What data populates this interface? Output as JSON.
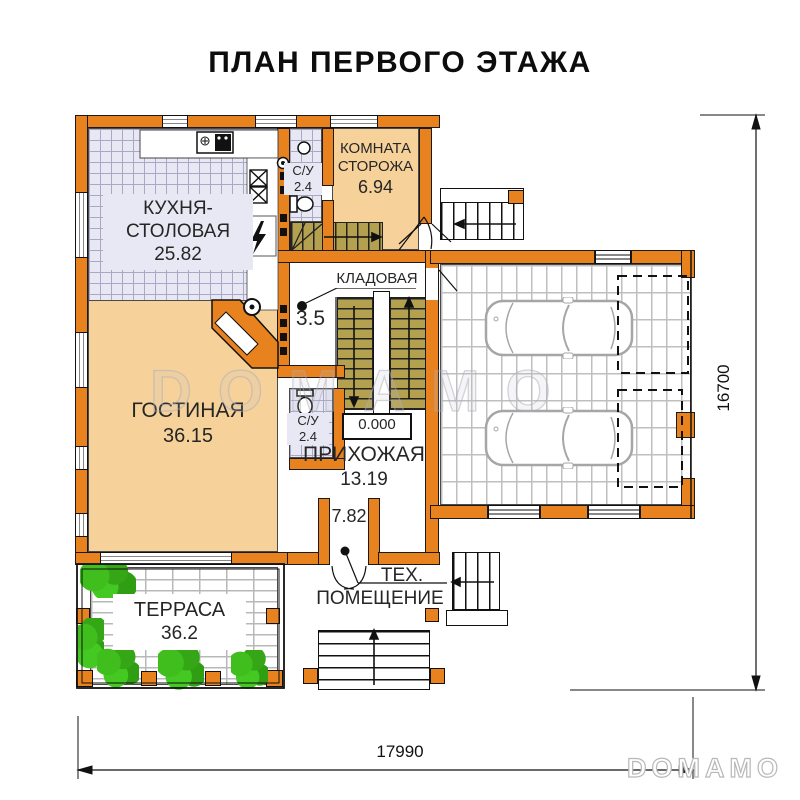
{
  "title": "ПЛАН ПЕРВОГО ЭТАЖА",
  "rooms": {
    "kitchen": {
      "name_line1": "КУХНЯ-",
      "name_line2": "СТОЛОВАЯ",
      "area": "25.82"
    },
    "guard": {
      "name_line1": "КОМНАТА",
      "name_line2": "СТОРОЖА",
      "area": "6.94"
    },
    "bath_top": {
      "name": "С/У",
      "area": "2.4"
    },
    "pantry": {
      "label": "КЛАДОВАЯ",
      "area": "3.5"
    },
    "living": {
      "name": "ГОСТИНАЯ",
      "area": "36.15"
    },
    "bath_bottom": {
      "name": "С/У",
      "area": "2.4"
    },
    "hallway": {
      "name": "ПРИХОЖАЯ",
      "area": "13.19"
    },
    "vestibule": {
      "area": "7.82"
    },
    "terrace": {
      "name": "ТЕРРАСА",
      "area": "36.2"
    },
    "tech": {
      "name_line1": "ТЕХ.",
      "name_line2": "ПОМЕЩЕНИЕ"
    }
  },
  "elevation_mark": "0.000",
  "dimensions": {
    "bottom_mm": "17990",
    "right_mm": "16700"
  },
  "watermark": "DOMAMO",
  "colors": {
    "wall_fill": "#E8821E",
    "warm_floor": "#F6D29A",
    "tile_floor": "#E8E8F4",
    "stair_tread": "#B3A150",
    "plant_green": "#3FBE1E",
    "line": "#1A1A1A"
  }
}
